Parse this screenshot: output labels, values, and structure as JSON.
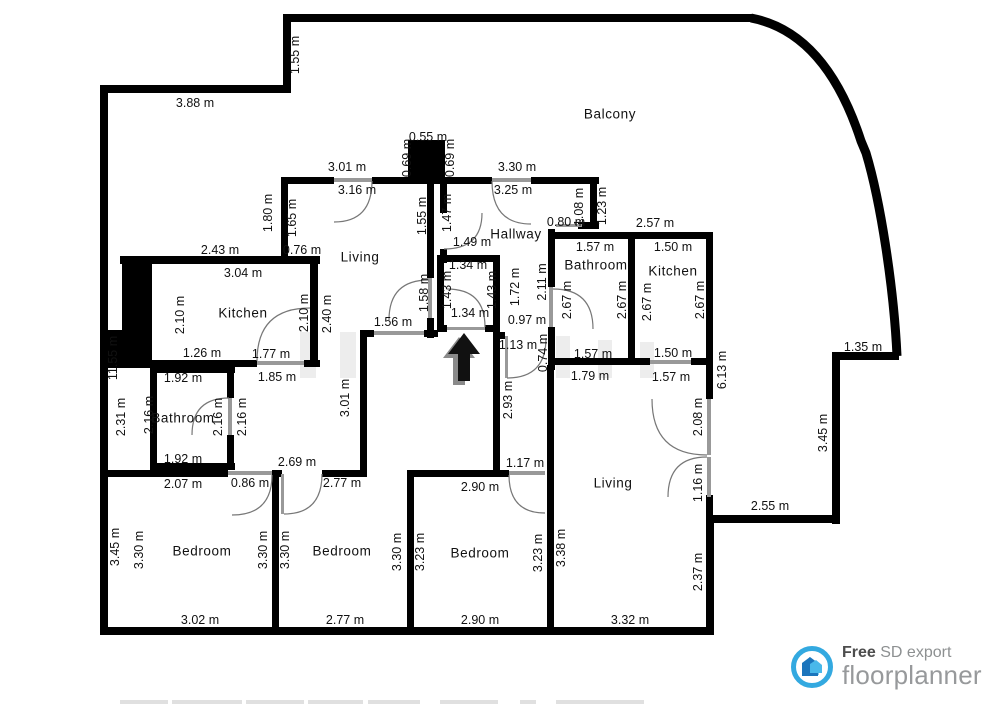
{
  "branding": {
    "free": "Free",
    "export": "SD export",
    "brand": "floorplanner"
  },
  "rooms": [
    {
      "name": "Balcony",
      "x": 610,
      "y": 114
    },
    {
      "name": "Living",
      "x": 360,
      "y": 257
    },
    {
      "name": "Hallway",
      "x": 516,
      "y": 234
    },
    {
      "name": "Kitchen",
      "x": 243,
      "y": 313
    },
    {
      "name": "Bathroom",
      "x": 183,
      "y": 418
    },
    {
      "name": "Bathroom",
      "x": 596,
      "y": 265
    },
    {
      "name": "Kitchen",
      "x": 673,
      "y": 271
    },
    {
      "name": "Living",
      "x": 613,
      "y": 483
    },
    {
      "name": "Bedroom",
      "x": 202,
      "y": 551
    },
    {
      "name": "Bedroom",
      "x": 342,
      "y": 551
    },
    {
      "name": "Bedroom",
      "x": 480,
      "y": 553
    }
  ],
  "dimensions": [
    {
      "text": "3.88 m",
      "x": 195,
      "y": 103,
      "rot": 0
    },
    {
      "text": "0.55 m",
      "x": 428,
      "y": 137,
      "rot": 0
    },
    {
      "text": "3.01 m",
      "x": 347,
      "y": 167,
      "rot": 0
    },
    {
      "text": "3.16 m",
      "x": 357,
      "y": 190,
      "rot": 0
    },
    {
      "text": "3.30 m",
      "x": 517,
      "y": 167,
      "rot": 0
    },
    {
      "text": "3.25 m",
      "x": 513,
      "y": 190,
      "rot": 0
    },
    {
      "text": "2.57 m",
      "x": 655,
      "y": 223,
      "rot": 0
    },
    {
      "text": "2.43 m",
      "x": 220,
      "y": 250,
      "rot": 0
    },
    {
      "text": "0.76 m",
      "x": 302,
      "y": 250,
      "rot": 0
    },
    {
      "text": "3.04 m",
      "x": 243,
      "y": 273,
      "rot": 0
    },
    {
      "text": "1.26 m",
      "x": 202,
      "y": 353,
      "rot": 0
    },
    {
      "text": "1.77 m",
      "x": 271,
      "y": 354,
      "rot": 0
    },
    {
      "text": "1.92 m",
      "x": 183,
      "y": 378,
      "rot": 0
    },
    {
      "text": "1.85 m",
      "x": 277,
      "y": 377,
      "rot": 0
    },
    {
      "text": "1.92 m",
      "x": 183,
      "y": 459,
      "rot": 0
    },
    {
      "text": "2.69 m",
      "x": 297,
      "y": 462,
      "rot": 0
    },
    {
      "text": "2.07 m",
      "x": 183,
      "y": 484,
      "rot": 0
    },
    {
      "text": "0.86 m",
      "x": 250,
      "y": 483,
      "rot": 0
    },
    {
      "text": "2.77 m",
      "x": 342,
      "y": 483,
      "rot": 0
    },
    {
      "text": "1.56 m",
      "x": 393,
      "y": 322,
      "rot": 0
    },
    {
      "text": "1.34 m",
      "x": 468,
      "y": 265,
      "rot": 0
    },
    {
      "text": "1.34 m",
      "x": 470,
      "y": 313,
      "rot": 0
    },
    {
      "text": "1.49 m",
      "x": 472,
      "y": 242,
      "rot": 0
    },
    {
      "text": "0.97 m",
      "x": 527,
      "y": 320,
      "rot": 0
    },
    {
      "text": "1.13 m",
      "x": 518,
      "y": 345,
      "rot": 0
    },
    {
      "text": "0.80 m",
      "x": 566,
      "y": 222,
      "rot": 0
    },
    {
      "text": "1.57 m",
      "x": 595,
      "y": 247,
      "rot": 0
    },
    {
      "text": "1.50 m",
      "x": 673,
      "y": 247,
      "rot": 0
    },
    {
      "text": "1.57 m",
      "x": 593,
      "y": 354,
      "rot": 0
    },
    {
      "text": "1.50 m",
      "x": 673,
      "y": 353,
      "rot": 0
    },
    {
      "text": "1.79 m",
      "x": 590,
      "y": 376,
      "rot": 0
    },
    {
      "text": "1.57 m",
      "x": 671,
      "y": 377,
      "rot": 0
    },
    {
      "text": "1.35 m",
      "x": 863,
      "y": 347,
      "rot": 0
    },
    {
      "text": "2.55 m",
      "x": 770,
      "y": 506,
      "rot": 0
    },
    {
      "text": "1.17 m",
      "x": 525,
      "y": 463,
      "rot": 0
    },
    {
      "text": "2.90 m",
      "x": 480,
      "y": 487,
      "rot": 0
    },
    {
      "text": "3.02 m",
      "x": 200,
      "y": 620,
      "rot": 0
    },
    {
      "text": "2.77 m",
      "x": 345,
      "y": 620,
      "rot": 0
    },
    {
      "text": "2.90 m",
      "x": 480,
      "y": 620,
      "rot": 0
    },
    {
      "text": "3.32 m",
      "x": 630,
      "y": 620,
      "rot": 0
    },
    {
      "text": "1.55 m",
      "x": 295,
      "y": 55,
      "rot": -90
    },
    {
      "text": "0.69 m",
      "x": 407,
      "y": 158,
      "rot": -90
    },
    {
      "text": "0.69 m",
      "x": 450,
      "y": 158,
      "rot": -90
    },
    {
      "text": "1.80 m",
      "x": 268,
      "y": 213,
      "rot": -90
    },
    {
      "text": "1.65 m",
      "x": 292,
      "y": 218,
      "rot": -90
    },
    {
      "text": "1.55 m",
      "x": 422,
      "y": 216,
      "rot": -90
    },
    {
      "text": "1.47 m",
      "x": 447,
      "y": 213,
      "rot": -90
    },
    {
      "text": "2.10 m",
      "x": 180,
      "y": 315,
      "rot": -90
    },
    {
      "text": "2.10 m",
      "x": 304,
      "y": 313,
      "rot": -90
    },
    {
      "text": "2.40 m",
      "x": 327,
      "y": 314,
      "rot": -90
    },
    {
      "text": "11.55 m",
      "x": 113,
      "y": 358,
      "rot": -90
    },
    {
      "text": "2.31 m",
      "x": 121,
      "y": 417,
      "rot": -90
    },
    {
      "text": "2.16 m",
      "x": 149,
      "y": 415,
      "rot": -90
    },
    {
      "text": "2.16 m",
      "x": 218,
      "y": 417,
      "rot": -90
    },
    {
      "text": "2.16 m",
      "x": 242,
      "y": 417,
      "rot": -90
    },
    {
      "text": "1.58 m",
      "x": 424,
      "y": 293,
      "rot": -90
    },
    {
      "text": "1.43 m",
      "x": 447,
      "y": 290,
      "rot": -90
    },
    {
      "text": "1.43 m",
      "x": 492,
      "y": 290,
      "rot": -90
    },
    {
      "text": "1.72 m",
      "x": 515,
      "y": 287,
      "rot": -90
    },
    {
      "text": "2.11 m",
      "x": 542,
      "y": 282,
      "rot": -90
    },
    {
      "text": "2.67 m",
      "x": 567,
      "y": 300,
      "rot": -90
    },
    {
      "text": "2.67 m",
      "x": 622,
      "y": 300,
      "rot": -90
    },
    {
      "text": "2.67 m",
      "x": 647,
      "y": 302,
      "rot": -90
    },
    {
      "text": "2.67 m",
      "x": 700,
      "y": 300,
      "rot": -90
    },
    {
      "text": "1.08 m",
      "x": 579,
      "y": 207,
      "rot": -90
    },
    {
      "text": "1.23 m",
      "x": 602,
      "y": 206,
      "rot": -90
    },
    {
      "text": "0.74 m",
      "x": 543,
      "y": 353,
      "rot": -90
    },
    {
      "text": "3.01 m",
      "x": 345,
      "y": 398,
      "rot": -90
    },
    {
      "text": "2.93 m",
      "x": 508,
      "y": 400,
      "rot": -90
    },
    {
      "text": "6.13 m",
      "x": 722,
      "y": 370,
      "rot": -90
    },
    {
      "text": "2.08 m",
      "x": 698,
      "y": 417,
      "rot": -90
    },
    {
      "text": "1.16 m",
      "x": 698,
      "y": 483,
      "rot": -90
    },
    {
      "text": "3.45 m",
      "x": 823,
      "y": 433,
      "rot": -90
    },
    {
      "text": "3.45 m",
      "x": 115,
      "y": 547,
      "rot": -90
    },
    {
      "text": "3.30 m",
      "x": 139,
      "y": 550,
      "rot": -90
    },
    {
      "text": "3.30 m",
      "x": 263,
      "y": 550,
      "rot": -90
    },
    {
      "text": "3.30 m",
      "x": 285,
      "y": 550,
      "rot": -90
    },
    {
      "text": "3.30 m",
      "x": 397,
      "y": 552,
      "rot": -90
    },
    {
      "text": "3.23 m",
      "x": 420,
      "y": 552,
      "rot": -90
    },
    {
      "text": "3.23 m",
      "x": 538,
      "y": 553,
      "rot": -90
    },
    {
      "text": "3.38 m",
      "x": 561,
      "y": 548,
      "rot": -90
    },
    {
      "text": "2.37 m",
      "x": 698,
      "y": 572,
      "rot": -90
    }
  ],
  "colors": {
    "wall": "#000000",
    "door": "#999999",
    "arc": "#777777",
    "brand_blue": "#33a9e0",
    "brand_gray": "#97999b"
  }
}
